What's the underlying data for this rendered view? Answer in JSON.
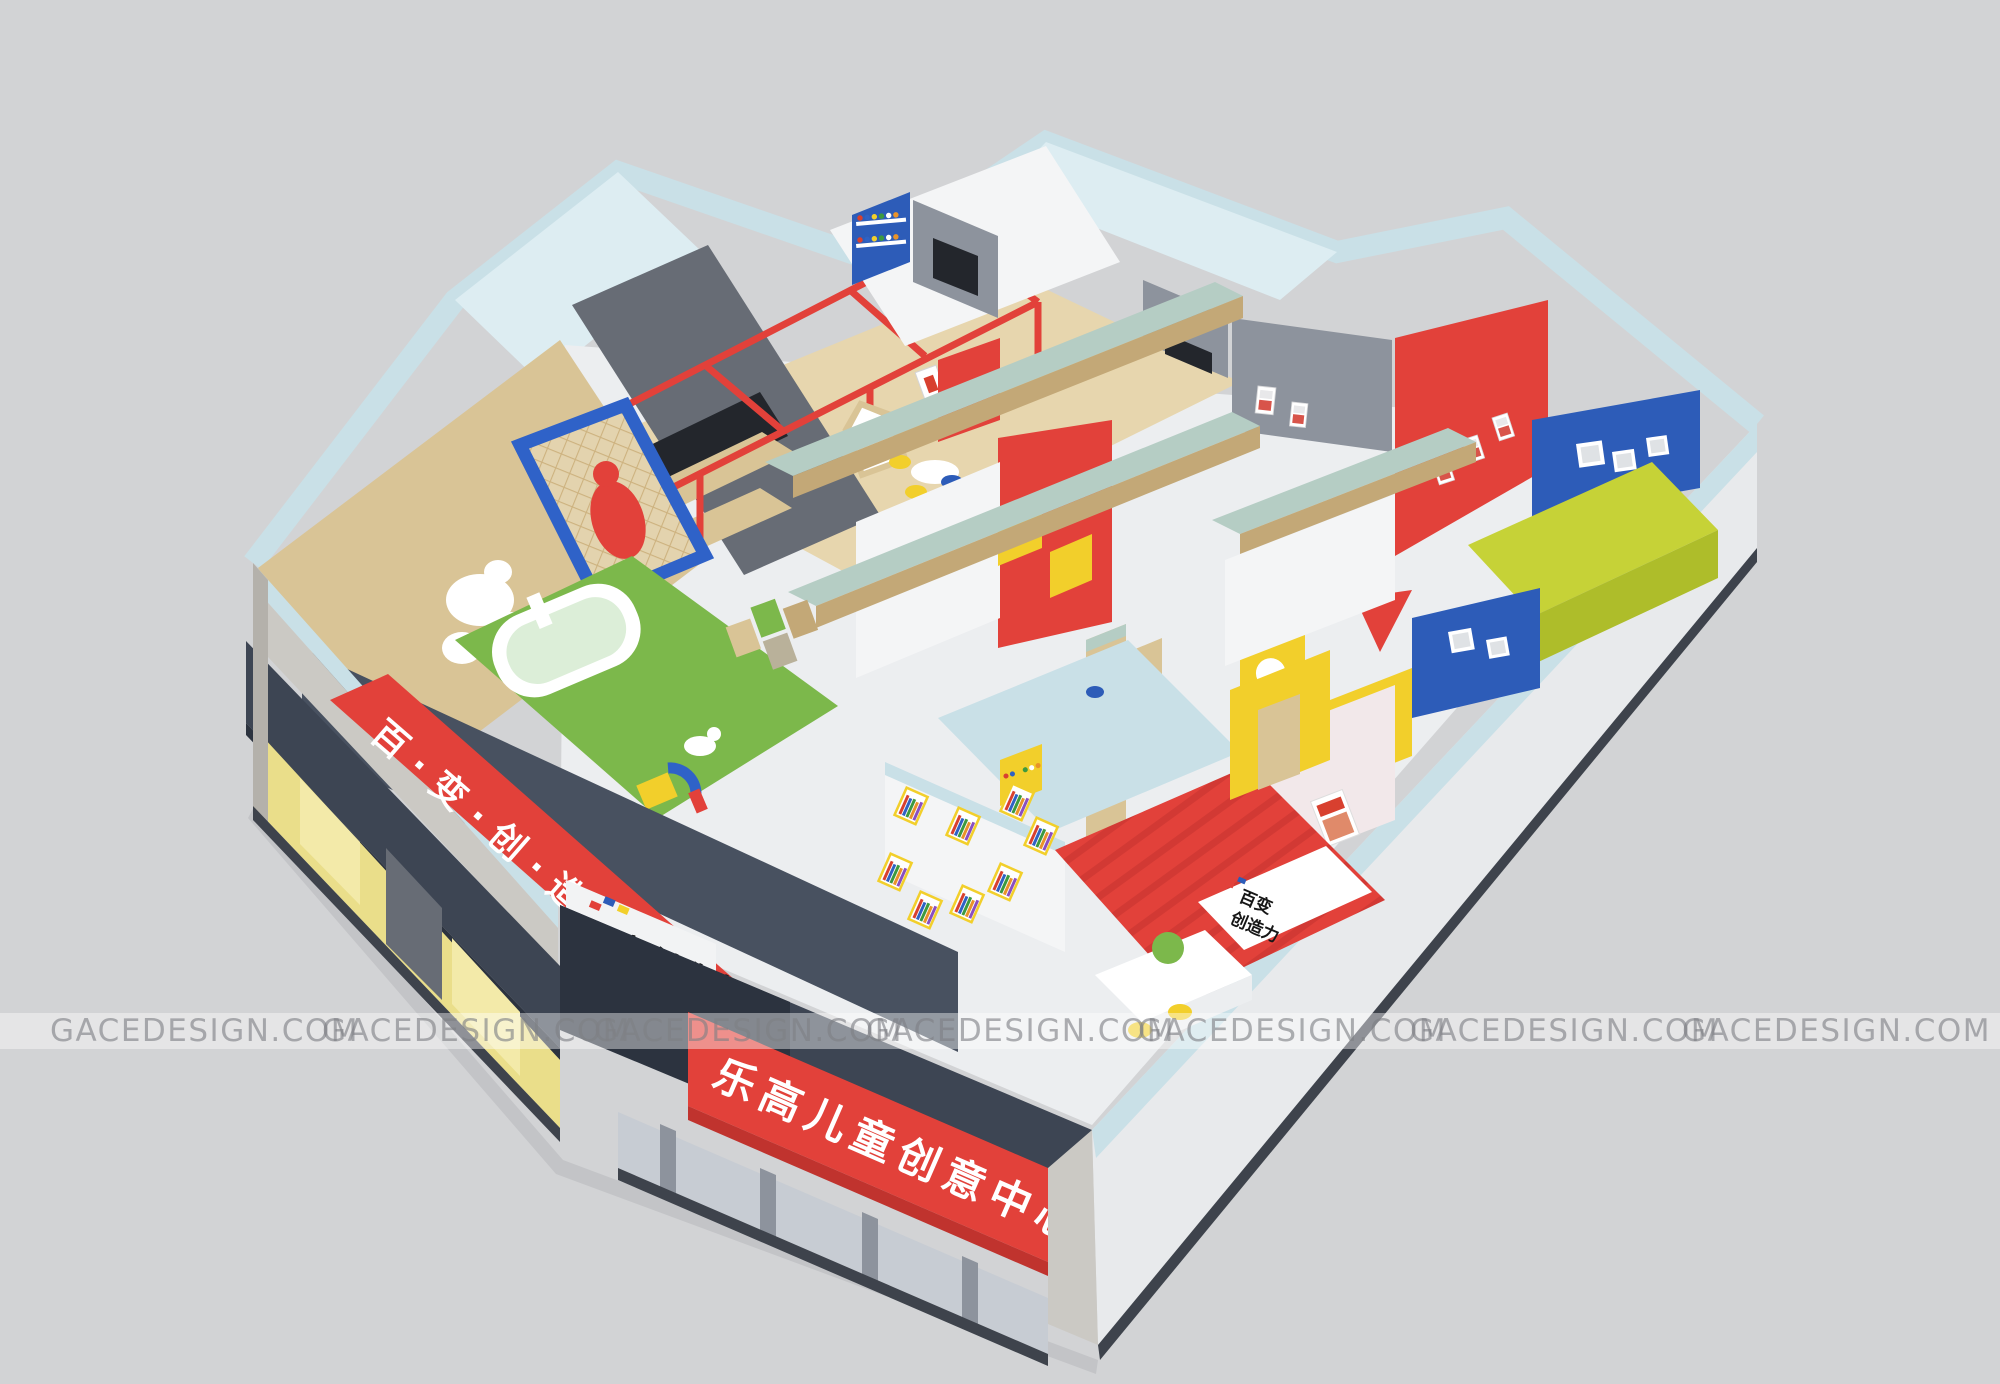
{
  "watermark": {
    "text": "GACEDESIGN.COM",
    "instances": 7
  },
  "signs": {
    "left_banner_text": "百·变·创·造·力",
    "front_banner_text": "乐高儿童创意中心",
    "storefront_logo_text": "百变创造力",
    "reception_logo_line1": "百变",
    "reception_logo_line2": "创造力"
  },
  "palette": {
    "bg": "#d2d3d5",
    "wallTop": "#c9e0e7",
    "wallTopLight": "#ddedf2",
    "wallFace": "#e8eaec",
    "whiteWall": "#f4f5f6",
    "concrete": "#cbc9c4",
    "concreteDark": "#b4b1ab",
    "awning": "#3d4553",
    "awningDark": "#2c333f",
    "red": "#e2413a",
    "redDark": "#c0332e",
    "yellow": "#f2cf2b",
    "yellowGlass": "#eade8a",
    "yellowGlassLight": "#f3eaa9",
    "wood": "#d9c496",
    "woodDark": "#c3a877",
    "woodFloor": "#e7d6ae",
    "beamTop": "#b5cdc4",
    "grayWall": "#8d939d",
    "grayWallDark": "#676c75",
    "screen": "#23262c",
    "blue": "#2d5cb8",
    "blueFrame": "#2f62c8",
    "turf": "#7cb84b",
    "poolWater": "#dceed8",
    "chartreuse": "#c6d237",
    "chartreuseDark": "#aebd2a",
    "floorLight": "#eceef0",
    "darkWedge": "#485160",
    "shadow": "#c3c4c7",
    "glass": "#aab0b8",
    "doorGlass": "#c7ccd3",
    "watermarkBand": "rgba(255,255,255,0.42)",
    "watermarkText": "rgba(126,128,132,0.62)"
  }
}
